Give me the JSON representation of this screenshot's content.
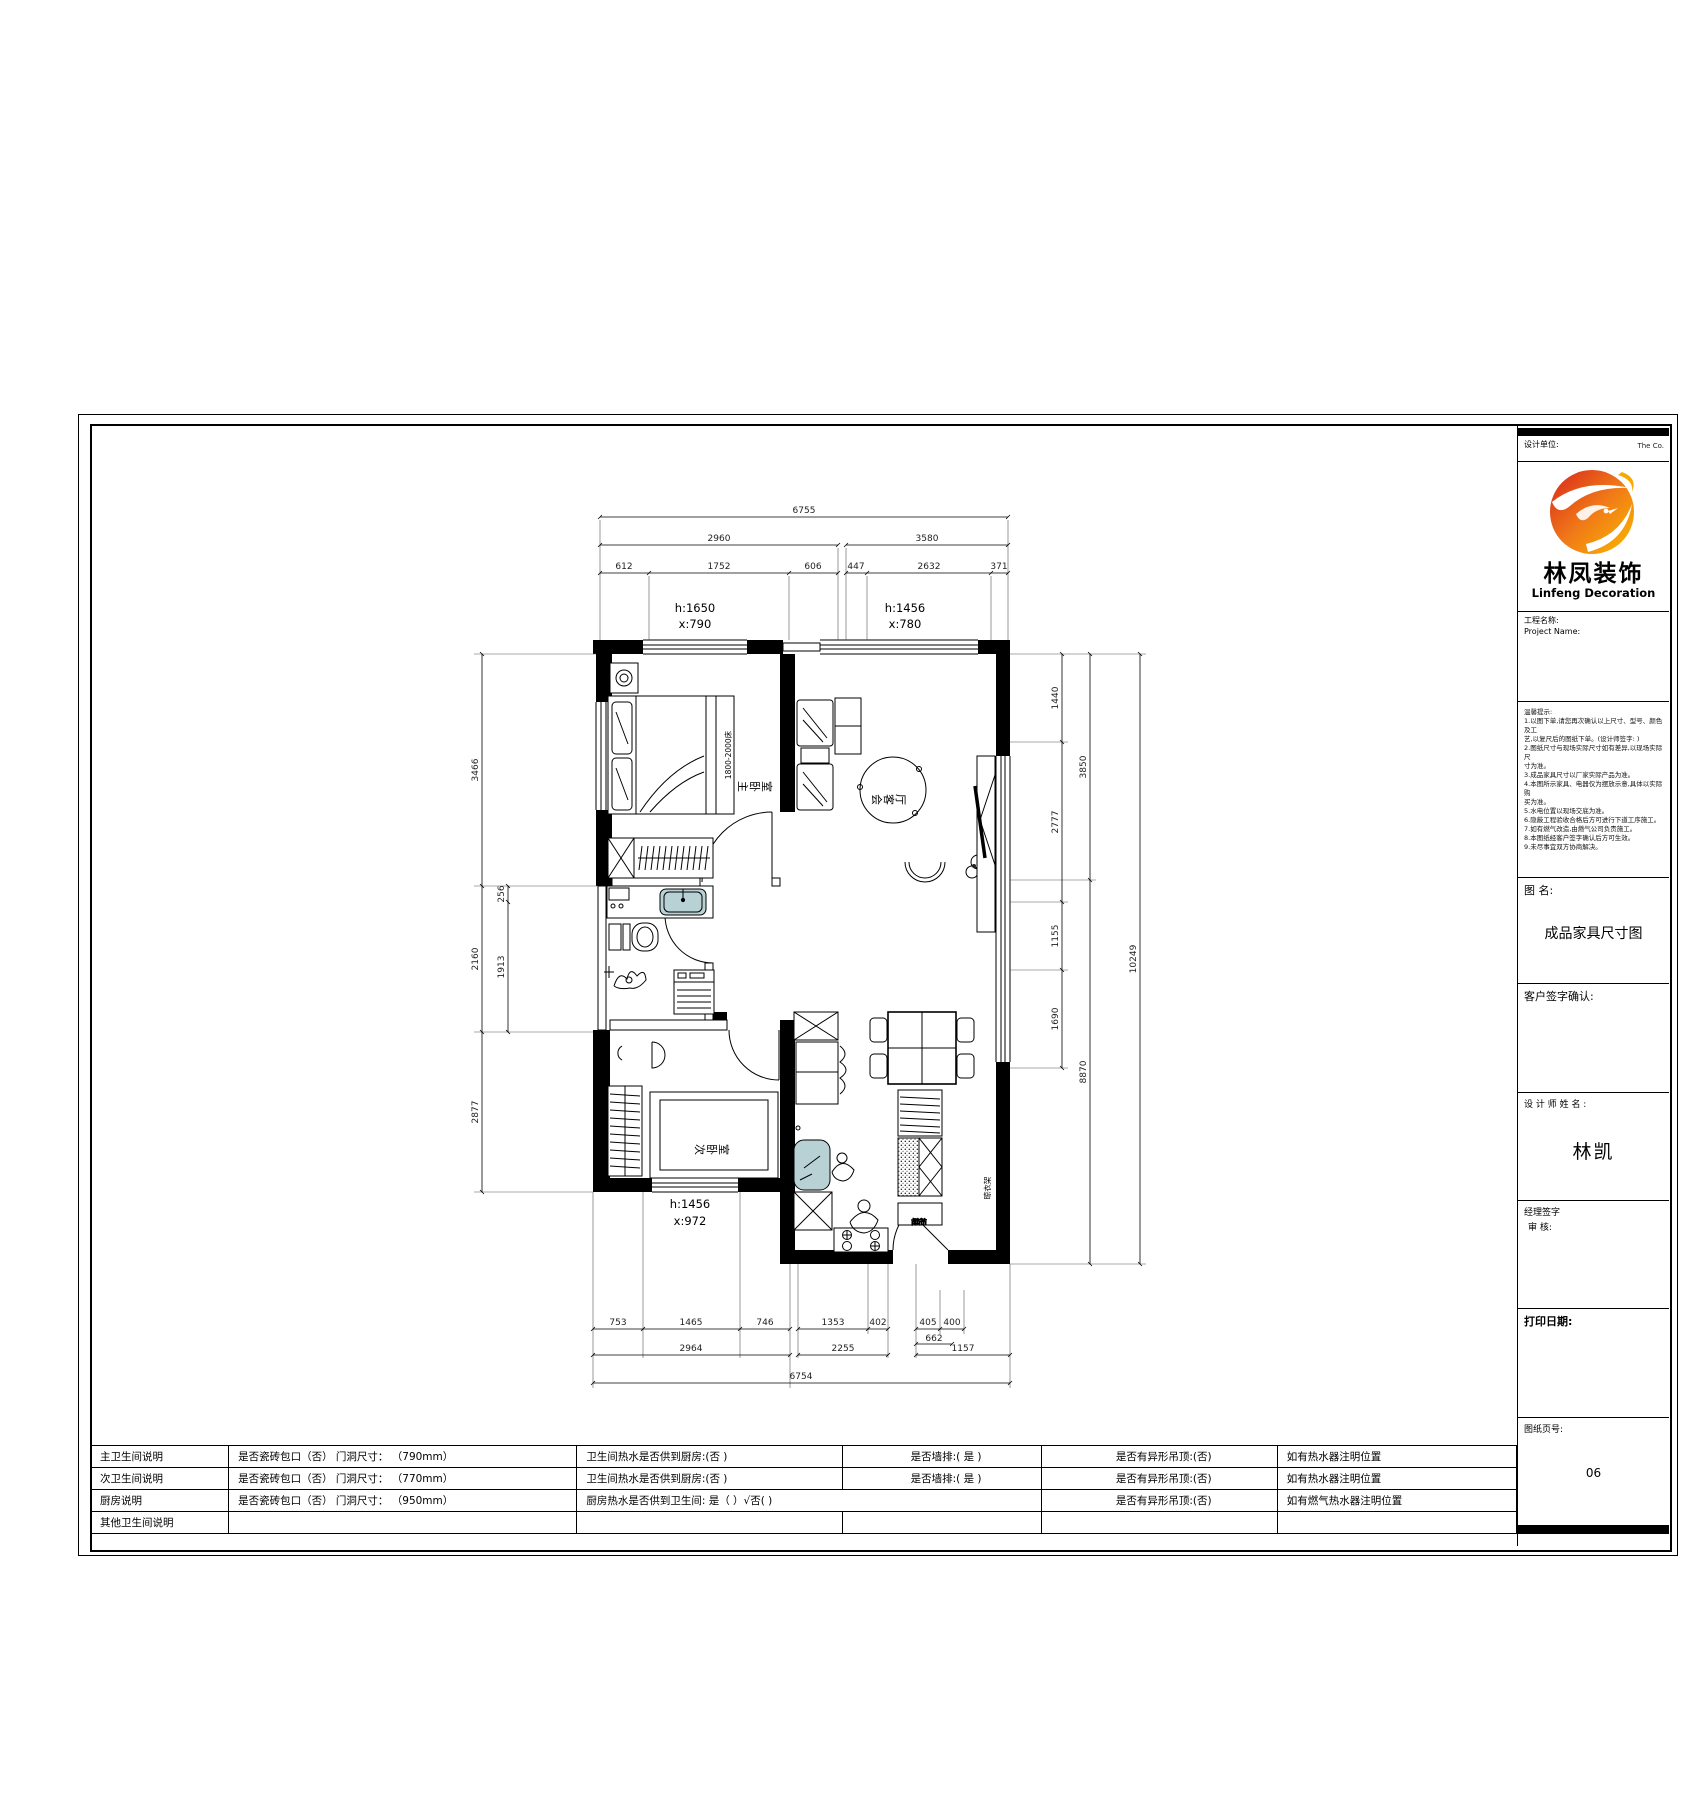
{
  "title_block": {
    "top_label": "设计单位:",
    "top_right": "The Co.",
    "brand_cn": "林凤装饰",
    "brand_en": "Linfeng Decoration",
    "project_label_cn": "工程名称:",
    "project_label_en": "Project Name:",
    "notes_title": "温馨提示:",
    "notes_lines": [
      "1.以图下单,请您再次确认以上尺寸、型号、颜色及工",
      "  艺,以复尺后的图纸下单。(设计师签字: )",
      "2.图纸尺寸与现场实际尺寸如有差异,以现场实际尺",
      "  寸为准。",
      "3.成品家具尺寸以厂家实际产品为准。",
      "4.本图所示家具、电器仅为摆放示意,具体以实际购",
      "  买为准。",
      "5.水电位置以现场交底为准。",
      "6.隐蔽工程验收合格后方可进行下道工序施工。",
      "7.如有燃气改造,由燃气公司负责施工。",
      "8.本图纸经客户签字确认后方可生效。",
      "9.未尽事宜双方协商解决。"
    ],
    "drawing_name_label": "图  名:",
    "drawing_name": "成品家具尺寸图",
    "customer_label": "客户签字确认:",
    "designer_label": "设 计 师 姓 名 :",
    "designer_name": "林凯",
    "manager_label": "经理签字",
    "review_label": "审  核:",
    "print_label": "打印日期:",
    "page_label": "图纸页号:",
    "page_no": "06"
  },
  "spec_table": {
    "rows": [
      [
        "主卫生间说明",
        "是否瓷砖包口（否） 门洞尺寸： （790mm）",
        "卫生间热水是否供到厨房:(否 )",
        "是否墙排:( 是 )",
        "是否有异形吊顶:(否)",
        "如有热水器注明位置"
      ],
      [
        "次卫生间说明",
        "是否瓷砖包口（否） 门洞尺寸： （770mm）",
        "卫生间热水是否供到厨房:(否 )",
        "是否墙排:( 是 )",
        "是否有异形吊顶:(否)",
        "如有热水器注明位置"
      ],
      [
        "厨房说明",
        "是否瓷砖包口（否） 门洞尺寸： （950mm）",
        "厨房热水是否供到卫生间: 是（ ）√否( )",
        "是否有异形吊顶:(否)",
        "如有燃气热水器注明位置"
      ],
      [
        "其他卫生间说明",
        "",
        "",
        "",
        "",
        ""
      ]
    ]
  },
  "plan": {
    "rooms": {
      "master": "主卧室",
      "living": "会客厅",
      "second": "次卧室"
    },
    "labels": {
      "bed": "1800-2000床",
      "shoe": "鞋柜",
      "rack": "晾衣架"
    },
    "windows": [
      {
        "h": "h:1650",
        "x": "x:790"
      },
      {
        "h": "h:1456",
        "x": "x:780"
      },
      {
        "h": "h:1456",
        "x": "x:972"
      }
    ],
    "dims": {
      "t_total": "6755",
      "t_left": "2960",
      "t_right": "3580",
      "t_sub": [
        "612",
        "1752",
        "606",
        "447",
        "2632",
        "371"
      ],
      "l_outer": [
        "3466",
        "2160",
        "2877"
      ],
      "l_inner": [
        "256",
        "1913"
      ],
      "r_a": [
        "1440",
        "2777",
        "1155",
        "1690"
      ],
      "r_b": [
        "3850",
        "8870"
      ],
      "r_c": "10249",
      "b_r1": [
        "753",
        "1465",
        "746",
        "1353",
        "402",
        "405",
        "400"
      ],
      "b_662": "662",
      "b_r2": [
        "2964",
        "2255",
        "1157"
      ],
      "b_total": "6754"
    },
    "accent_color": "#b8d1d5",
    "logo_colors": {
      "red": "#d7261c",
      "orange": "#f07818",
      "yellow": "#fbb900"
    }
  }
}
